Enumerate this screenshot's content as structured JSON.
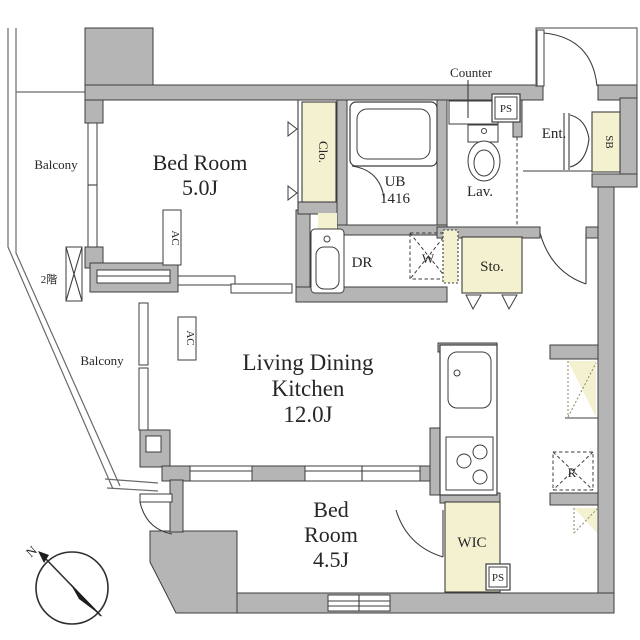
{
  "plan": {
    "colors": {
      "wall_fill": "#b5b5b5",
      "outline": "#3d3d3d",
      "storage_yellow": "#f4f1d0",
      "background": "#ffffff"
    },
    "rooms": {
      "bedroom_main": {
        "name": "Bed Room",
        "size": "5.0J"
      },
      "ldk": {
        "name_line1": "Living Dining",
        "name_line2": "Kitchen",
        "size": "12.0J"
      },
      "bedroom_second": {
        "name_line1": "Bed",
        "name_line2": "Room",
        "size": "4.5J"
      }
    },
    "labels": {
      "balcony_upper": "Balcony",
      "balcony_lower": "Balcony",
      "closet": "Clo.",
      "unit_bath": "UB",
      "unit_bath_size": "1416",
      "counter": "Counter",
      "lavatory": "Lav.",
      "pipe_space_top": "PS",
      "pipe_space_bottom": "PS",
      "entrance": "Ent.",
      "shoe_box": "SB",
      "storage": "Sto.",
      "dressing_room": "DR",
      "washing_machine": "W",
      "air_conditioner_1": "AC",
      "air_conditioner_2": "AC",
      "walk_in_closet": "WIC",
      "refrigerator": "R",
      "floor_note": "2階",
      "compass_north": "N"
    }
  }
}
